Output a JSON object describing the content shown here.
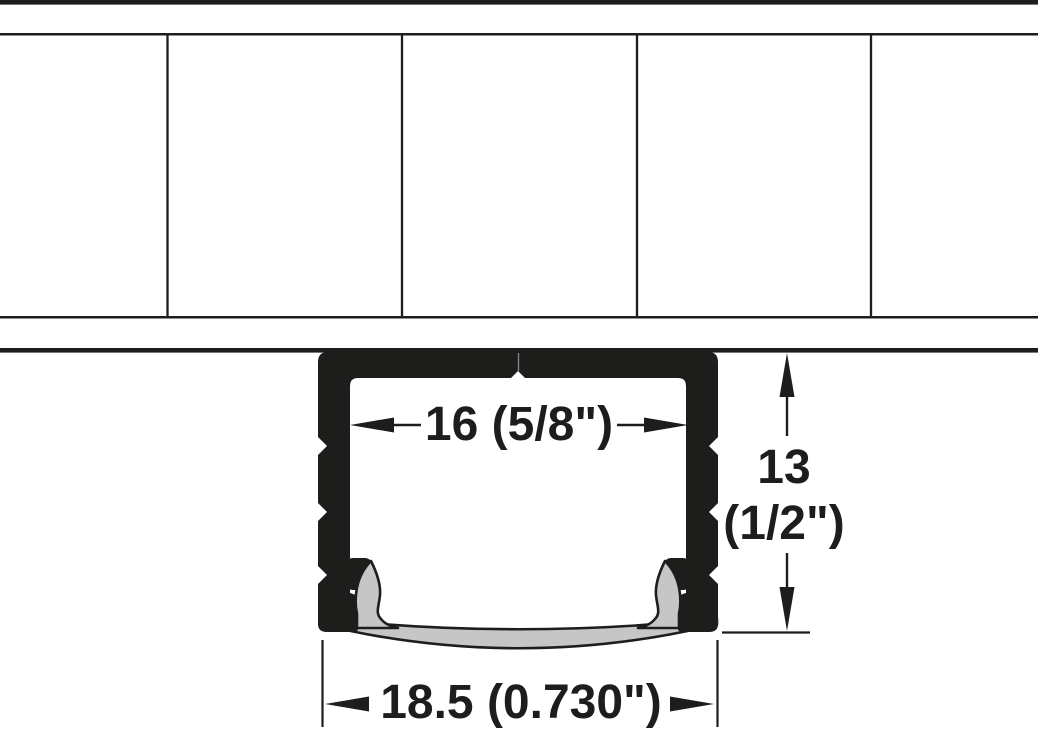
{
  "diagram": {
    "dimensions": {
      "inner_width": {
        "label": "16 (5/8\")"
      },
      "height": {
        "line1": "13",
        "line2": "(1/2\")"
      },
      "outer_width": {
        "label": "18.5 (0.730\")"
      }
    },
    "colors": {
      "profile": "#1d1d1b",
      "lens": "#c6c6c6",
      "hairline": "#8a8a8a",
      "background": "#ffffff"
    }
  }
}
